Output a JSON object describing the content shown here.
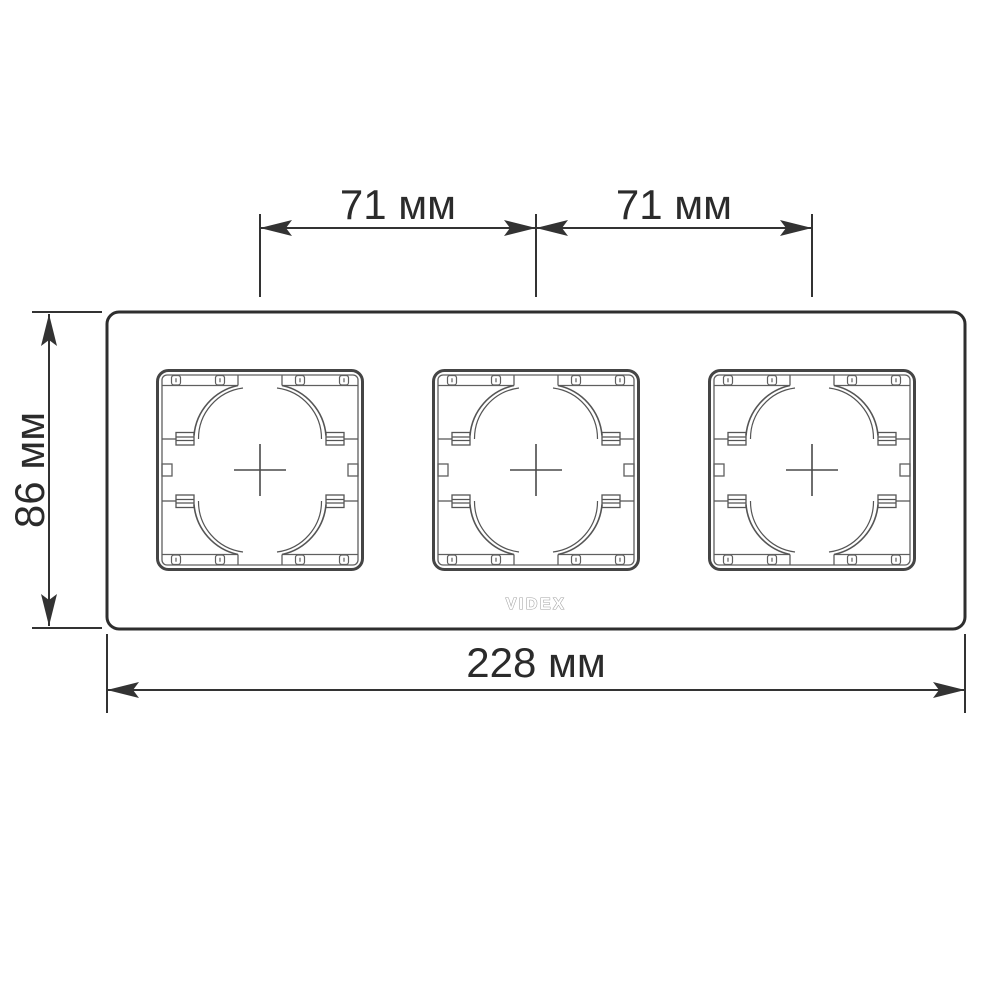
{
  "drawing": {
    "type": "product-dimension-diagram",
    "subject": "triple-gang wall plate frame, front view",
    "brand": {
      "logo_text": "VIDEX"
    },
    "dimensions": {
      "spacing_left": "71 мм",
      "spacing_right": "71 мм",
      "height": "86 мм",
      "width": "228 мм"
    },
    "apertures": {
      "count": 3
    },
    "colors": {
      "background": "#ffffff",
      "frame_outline": "#2e2e2e",
      "aperture_outline": "#454545",
      "aperture_detail": "#5f5f5f",
      "dimension_line": "#333333",
      "dimension_text": "#2b2b2b",
      "logo": "#a2a2a2"
    }
  }
}
